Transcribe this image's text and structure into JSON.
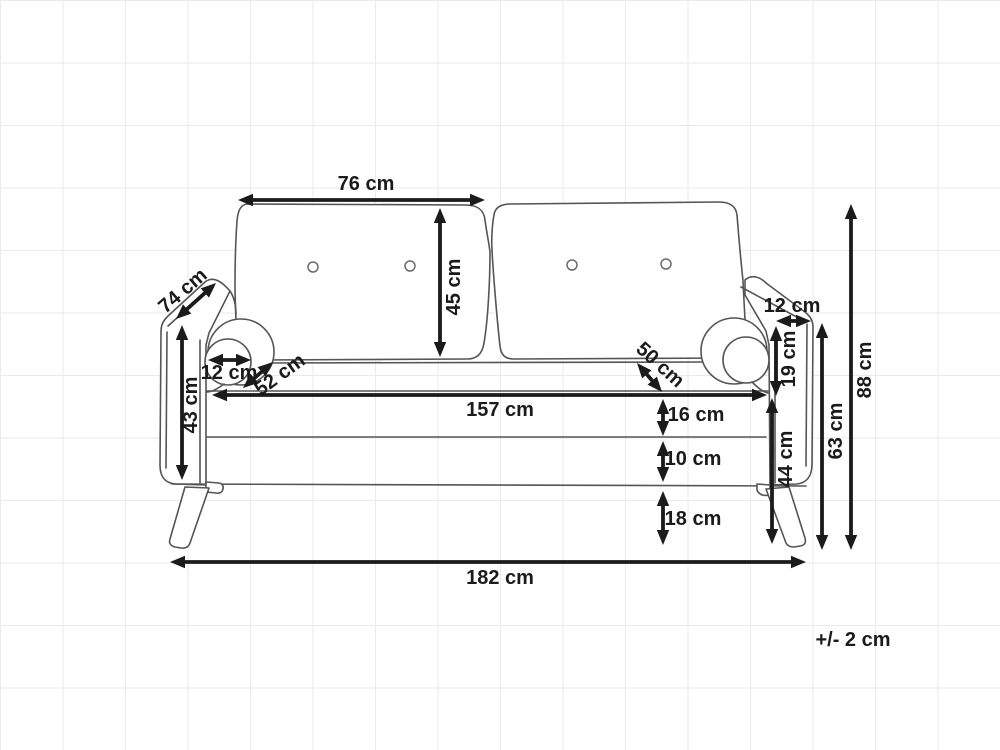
{
  "diagram": {
    "type": "furniture-dimension-drawing",
    "subject": "two-seater sofa, front view with dimension arrows",
    "unit": "cm",
    "tolerance_note": "+/- 2 cm"
  },
  "colors": {
    "background": "#ffffff",
    "grid_line": "#e8eaec",
    "sofa_outline": "#555556",
    "dimension_ink": "#1b1b1b"
  },
  "dimensions": [
    {
      "name": "backrest-cushion-width",
      "label": "76 cm",
      "x1": 238,
      "y1": 200,
      "x2": 485,
      "y2": 200,
      "lx": 366,
      "ly": 184,
      "rot": 0
    },
    {
      "name": "backrest-cushion-height",
      "label": "45 cm",
      "x1": 440,
      "y1": 208,
      "x2": 440,
      "y2": 357,
      "lx": 454,
      "ly": 287,
      "rot": -90
    },
    {
      "name": "sofa-depth",
      "label": "74 cm",
      "x1": 176,
      "y1": 319,
      "x2": 216,
      "y2": 283,
      "lx": 183,
      "ly": 291,
      "rot": -41
    },
    {
      "name": "armrest-height",
      "label": "43 cm",
      "x1": 182,
      "y1": 325,
      "x2": 182,
      "y2": 480,
      "lx": 191,
      "ly": 405,
      "rot": -90
    },
    {
      "name": "bolster-diameter",
      "label": "12 cm",
      "x1": 208,
      "y1": 360,
      "x2": 251,
      "y2": 360,
      "lx": 229,
      "ly": 373,
      "rot": 0
    },
    {
      "name": "seat-depth-left",
      "label": "52 cm",
      "x1": 243,
      "y1": 388,
      "x2": 273,
      "y2": 362,
      "lx": 280,
      "ly": 375,
      "rot": -36
    },
    {
      "name": "inner-seat-width",
      "label": "157 cm",
      "x1": 212,
      "y1": 395,
      "x2": 767,
      "y2": 395,
      "lx": 500,
      "ly": 410,
      "rot": 0
    },
    {
      "name": "seat-depth-right",
      "label": "50 cm",
      "x1": 637,
      "y1": 363,
      "x2": 662,
      "y2": 392,
      "lx": 660,
      "ly": 365,
      "rot": 42
    },
    {
      "name": "armrest-top-width",
      "label": "12 cm",
      "x1": 776,
      "y1": 321,
      "x2": 811,
      "y2": 321,
      "lx": 792,
      "ly": 306,
      "rot": 0
    },
    {
      "name": "armrest-above-seat",
      "label": "19 cm",
      "x1": 776,
      "y1": 326,
      "x2": 776,
      "y2": 396,
      "lx": 789,
      "ly": 359,
      "rot": -90
    },
    {
      "name": "seat-cushion-thickness",
      "label": "16 cm",
      "x1": 663,
      "y1": 399,
      "x2": 663,
      "y2": 436,
      "lx": 696,
      "ly": 415,
      "rot": 0
    },
    {
      "name": "base-frame-height",
      "label": "10 cm",
      "x1": 663,
      "y1": 441,
      "x2": 663,
      "y2": 482,
      "lx": 693,
      "ly": 459,
      "rot": 0
    },
    {
      "name": "leg-height",
      "label": "18 cm",
      "x1": 663,
      "y1": 491,
      "x2": 663,
      "y2": 545,
      "lx": 693,
      "ly": 519,
      "rot": 0
    },
    {
      "name": "seat-height",
      "label": "44 cm",
      "x1": 772,
      "y1": 398,
      "x2": 772,
      "y2": 544,
      "lx": 786,
      "ly": 459,
      "rot": -90
    },
    {
      "name": "armrest-floor-height",
      "label": "63 cm",
      "x1": 822,
      "y1": 323,
      "x2": 822,
      "y2": 550,
      "lx": 836,
      "ly": 431,
      "rot": -90
    },
    {
      "name": "total-height",
      "label": "88 cm",
      "x1": 851,
      "y1": 204,
      "x2": 851,
      "y2": 550,
      "lx": 865,
      "ly": 370,
      "rot": -90
    },
    {
      "name": "total-width",
      "label": "182 cm",
      "x1": 170,
      "y1": 562,
      "x2": 806,
      "y2": 562,
      "lx": 500,
      "ly": 578,
      "rot": 0
    }
  ]
}
